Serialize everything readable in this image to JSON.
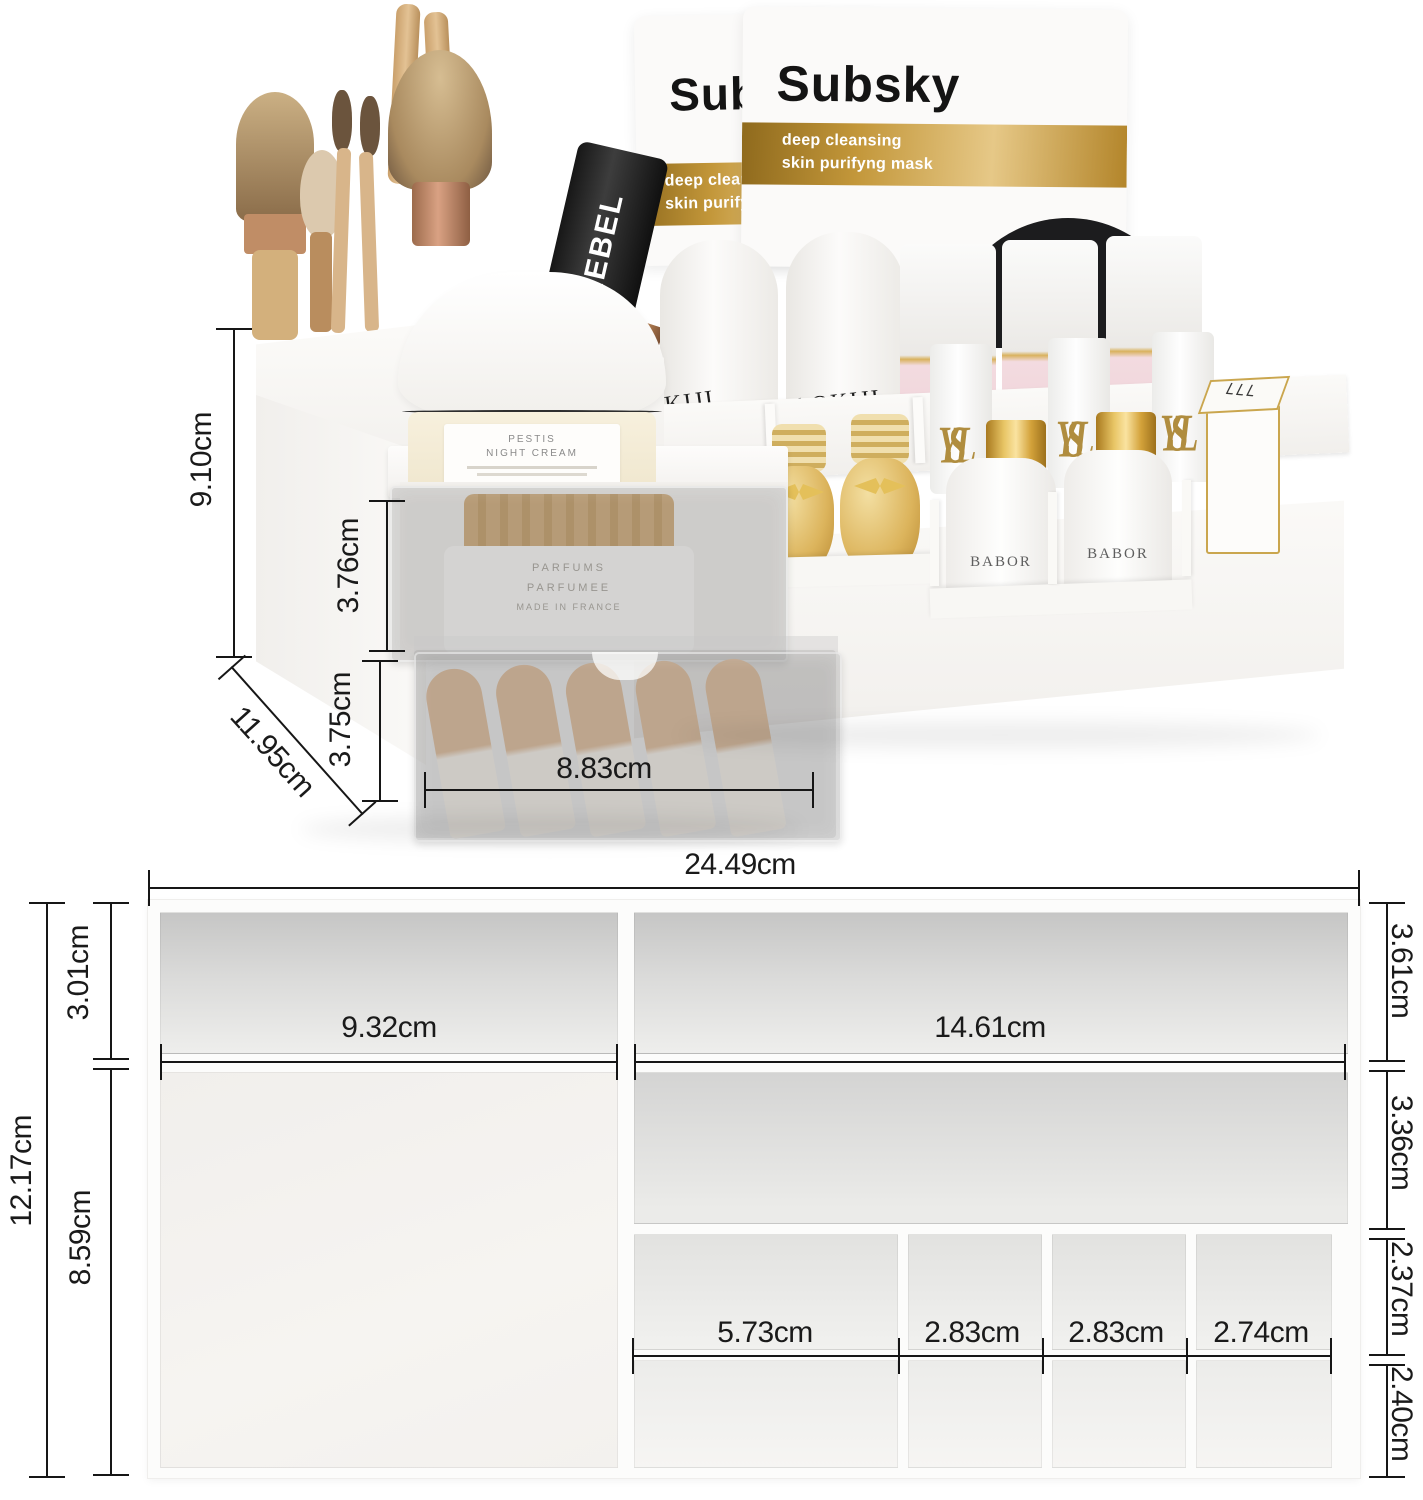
{
  "photo": {
    "dims": {
      "total_height": "9.10cm",
      "drawer1_height": "3.76cm",
      "drawer2_height": "3.75cm",
      "depth": "11.95cm",
      "drawer_inner_width": "8.83cm"
    },
    "products": {
      "mask_brand": "Subsky",
      "mask_line1": "deep cleansing",
      "mask_line2": "skin purifyng mask",
      "mascara_brand": "REBEL",
      "cream_jar_line1": "PESTIS",
      "cream_jar_line2": "NIGHT CREAM",
      "lotion_brand": "AOKIJI",
      "serum_brand": "BABOR",
      "lipstick_monogram": "YSL",
      "lipstick_case_mark": "LLL",
      "parfum_jar_line1": "PARFUMS",
      "parfum_jar_line2": "PARFUMEE",
      "parfum_jar_line3": "MADE IN FRANCE"
    }
  },
  "diagram": {
    "overall_width": "24.49cm",
    "overall_depth": "12.17cm",
    "left_back_depth": "3.01cm",
    "left_width": "9.32cm",
    "left_main_depth": "8.59cm",
    "right_width": "14.61cm",
    "right_back_depth": "3.61cm",
    "right_mid_depth": "3.36cm",
    "right_row3_depth": "2.37cm",
    "right_row4_depth": "2.40cm",
    "columns": [
      {
        "label": "5.73cm"
      },
      {
        "label": "2.83cm"
      },
      {
        "label": "2.83cm"
      },
      {
        "label": "2.74cm"
      }
    ]
  },
  "colors": {
    "dimension_line": "#161616",
    "gold_band": "#c3973a",
    "acrylic_tint": "#767676",
    "organizer_white": "#fbfaf8"
  }
}
